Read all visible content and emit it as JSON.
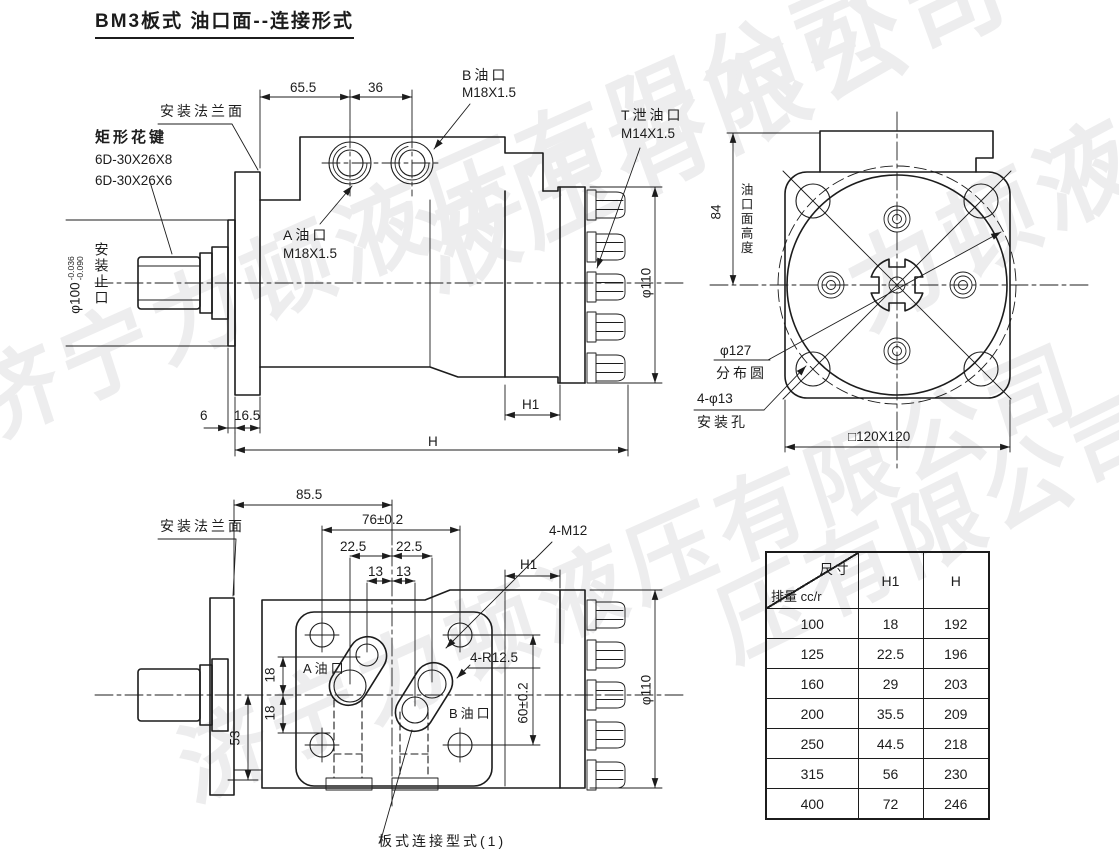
{
  "title": "BM3板式 油口面--连接形式",
  "watermark": {
    "text": "济宁力顿液压有限公司",
    "instances": [
      "济宁力顿液压有限公司",
      "液压有限公司",
      "力顿液压",
      "济宁力顿液压有限公司",
      "压有限公司"
    ]
  },
  "side_view": {
    "flange_face": "安装法兰面",
    "spline_title": "矩形花键",
    "spline_spec_1": "6D-30X26X8",
    "spline_spec_2": "6D-30X26X6",
    "dim_65_5": "65.5",
    "dim_36": "36",
    "port_b": "B油口",
    "port_b_thread": "M18X1.5",
    "port_t": "T泄油口",
    "port_t_thread": "M14X1.5",
    "port_a": "A油口",
    "port_a_thread": "M18X1.5",
    "shaft_dia": "φ100",
    "shaft_tol_upper": "-0.036",
    "shaft_tol_lower": "-0.090",
    "spigot": "安装止口",
    "dim_6": "6",
    "dim_16_5": "16.5",
    "dim_h1": "H1",
    "dim_h": "H",
    "dia_110": "φ110"
  },
  "front_view": {
    "dim_84": "84",
    "port_face_height": "油口面高度",
    "bolt_circle_dia": "φ127",
    "bolt_circle": "分布圆",
    "mount_hole_dia": "4-φ13",
    "mount_hole": "安装孔",
    "square": "□120X120"
  },
  "bottom_view": {
    "flange_face": "安装法兰面",
    "dim_85_5": "85.5",
    "dim_76": "76±0.2",
    "dim_22_5": "22.5",
    "dim_13": "13",
    "thread_holes": "4-M12",
    "dim_h1": "H1",
    "port_a": "A油口",
    "slot_radius": "4-R12.5",
    "port_b": "B油口",
    "dim_60": "60±0.2",
    "dim_18": "18",
    "dim_53": "53",
    "dia_110": "φ110",
    "plate_type": "板式连接型式(1)"
  },
  "table": {
    "corner_top": "尺寸",
    "corner_bottom": "排量 cc/r",
    "col_h1": "H1",
    "col_h": "H",
    "rows": [
      {
        "d": "100",
        "h1": "18",
        "h": "192"
      },
      {
        "d": "125",
        "h1": "22.5",
        "h": "196"
      },
      {
        "d": "160",
        "h1": "29",
        "h": "203"
      },
      {
        "d": "200",
        "h1": "35.5",
        "h": "209"
      },
      {
        "d": "250",
        "h1": "44.5",
        "h": "218"
      },
      {
        "d": "315",
        "h1": "56",
        "h": "230"
      },
      {
        "d": "400",
        "h1": "72",
        "h": "246"
      }
    ]
  }
}
